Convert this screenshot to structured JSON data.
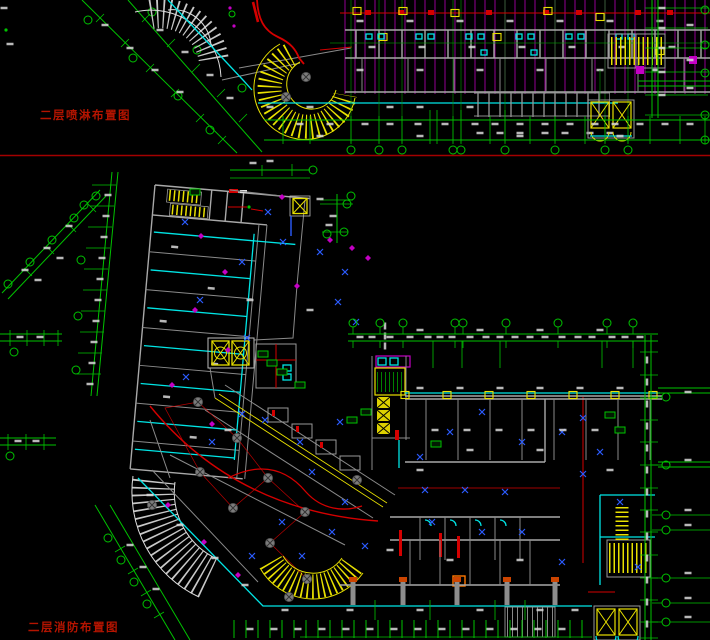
{
  "app": {
    "type": "cad-drawing-viewer",
    "background": "#000000"
  },
  "sheets": {
    "separator_color": "#a30000",
    "top": {
      "title": "二层喷淋布置图",
      "title_color": "#b41400"
    },
    "bottom": {
      "title": "二层消防布置图",
      "title_color": "#b41400"
    }
  },
  "palette": {
    "dimension_green": "#00c300",
    "pipe_cyan": "#00e5e5",
    "pipe_red": "#d40000",
    "stair_yellow": "#e8e000",
    "branch_magenta": "#c400c4",
    "wall_gray": "#9a9a9a",
    "sprinkler_blue": "#2b5cff",
    "label_white": "#d8d8d8"
  }
}
